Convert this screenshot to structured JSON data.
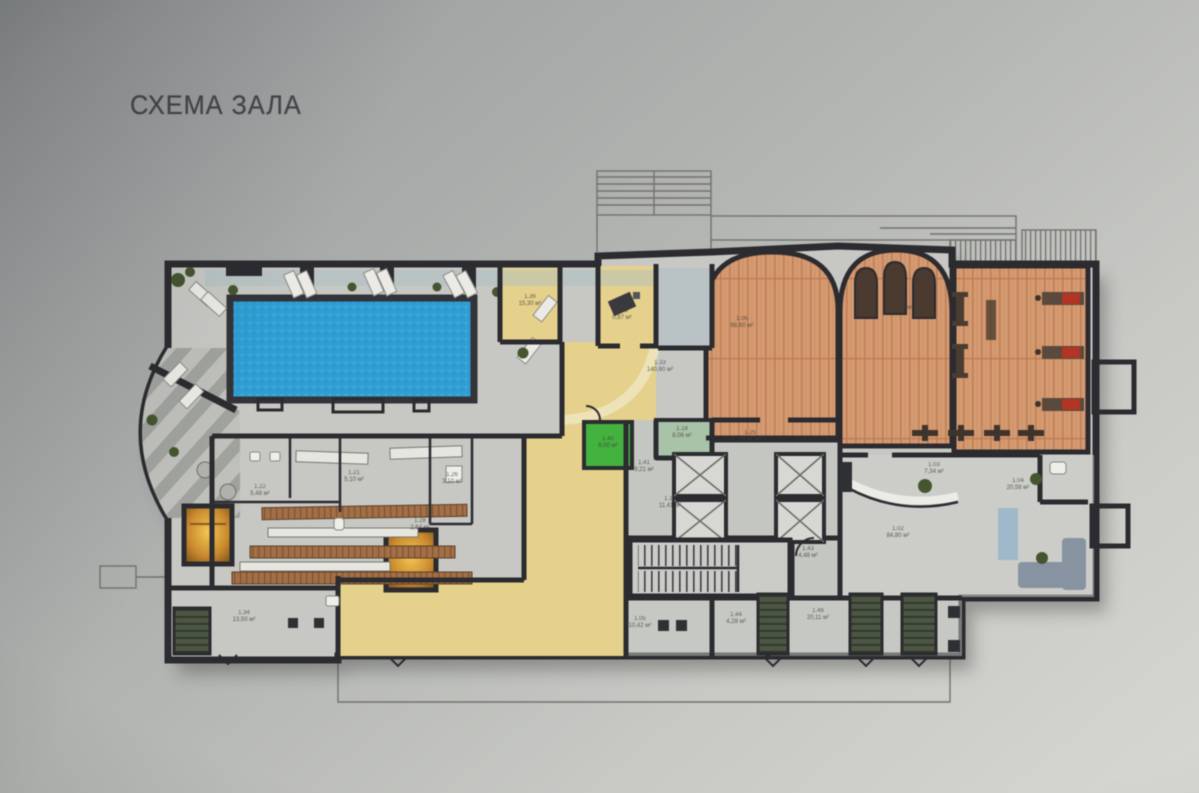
{
  "title": "СХЕМА ЗАЛА",
  "rooms": [
    {
      "id": "1.36",
      "area": "15,30 м²"
    },
    {
      "id": "1.13",
      "area": "0,87 м²"
    },
    {
      "id": "1.33",
      "area": "140,60 м²"
    },
    {
      "id": "1.06",
      "area": "68,60 м²"
    },
    {
      "id": "1.07",
      "area": "74,42 м²"
    },
    {
      "id": "1.18",
      "area": "8,06 м²"
    },
    {
      "id": "1.40",
      "area": "6,00 м²"
    },
    {
      "id": "1.41",
      "area": "9,21 м²"
    },
    {
      "id": "1.15",
      "area": "11,41 м²"
    },
    {
      "id": "1.25",
      "area": "10,87 м²"
    },
    {
      "id": "1.43",
      "area": "4,48 м²"
    },
    {
      "id": "1.44",
      "area": "4,28 м²"
    },
    {
      "id": "1.05",
      "area": "10,42 м²"
    },
    {
      "id": "1.46",
      "area": "20,11 м²"
    },
    {
      "id": "1.02",
      "area": "84,80 м²"
    },
    {
      "id": "1.04",
      "area": "20,58 м²"
    },
    {
      "id": "1.03",
      "area": "7,34 м²"
    },
    {
      "id": "1.34",
      "area": "13,50 м²"
    },
    {
      "id": "1.22",
      "area": "5,48 м²"
    },
    {
      "id": "1.21",
      "area": "5,10 м²"
    },
    {
      "id": "1.28",
      "area": "2,64 м²"
    },
    {
      "id": "1.26",
      "area": "3,10 м²"
    }
  ],
  "colors": {
    "background": "#b5b7b4",
    "walls": "#2b2b30",
    "pool_water": "#2f9ed3",
    "wood_floor": "#d59a71",
    "corridor_yellow": "#e5d18c",
    "green_room": "#44b23e",
    "pale_green_room": "#a9c3a8",
    "sauna_glow": "#e8b84a",
    "entrance_stairs": "#4d5644",
    "sofa": "#8893a2"
  }
}
